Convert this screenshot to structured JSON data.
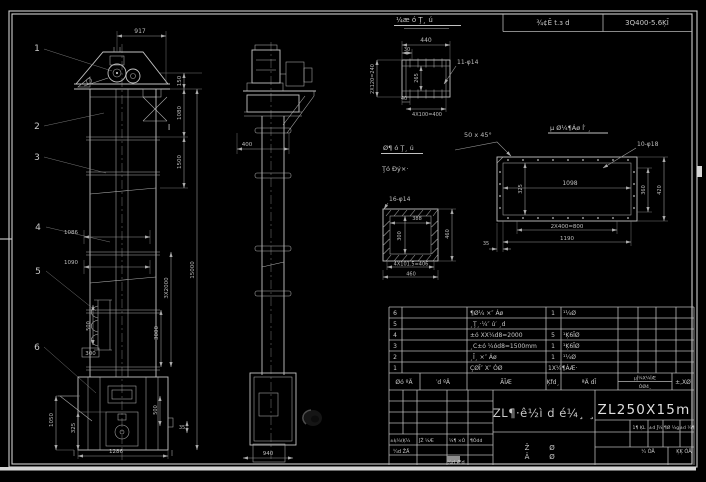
{
  "topbar": {
    "cell1": "¾¢Ē t.з d",
    "cell2": "3Q400-5.6ĶĪ"
  },
  "detail_channel": {
    "title": "¼æ ó Ţ¸ ú",
    "dim_width": "440",
    "dim_offset": "30",
    "dim_left": "2X120=240",
    "dim_inner": "265",
    "holes": "11-φ14",
    "dim_small": "40",
    "dim_bottom": "4X100=400"
  },
  "chamfer_note": "50 x 45°",
  "detail_frame": {
    "title": "µ Ø¼¶Áø ĺ′ ¸",
    "holes": "10-φ18",
    "dim_inner_width": "1098",
    "dim_left": "325",
    "dim_bottom1": "2X400=800",
    "dim_bottom2": "1190",
    "dim_right1": "360",
    "dim_right2": "420",
    "dim_gap": "35"
  },
  "detail_square": {
    "title_line1": "Ø¶ ó Ţ¸ ú",
    "title_line2": "Ţó Ðý×·",
    "holes": "16-φ14",
    "dim_inner_width": "388",
    "dim_inner_height": "300",
    "dim_right": "460",
    "dim_bottom1": "4X101.5=406",
    "dim_bottom2": "460"
  },
  "front_view": {
    "balloons": [
      "1",
      "2",
      "3",
      "4",
      "5",
      "6"
    ],
    "section_mark": "I",
    "box_label": "300",
    "dims": {
      "top_width": "917",
      "head_h": "150",
      "upper_h": "1080",
      "mid_h": "1500",
      "total_h": "15000",
      "sections": "3X2000",
      "w1": "1086",
      "w2": "1090",
      "bucket_pitch": "500",
      "seg": "3000",
      "boot_h": "1050",
      "door_h": "325",
      "boot_w": "1286",
      "spout_h": "500",
      "gap": "35"
    }
  },
  "side_view": {
    "dims": {
      "width": "400",
      "base_width": "940"
    }
  },
  "bom": {
    "headers": {
      "no": "Øó ºÄ",
      "code": "′d ºÄ",
      "name": "ÃĪÆ",
      "qty": "Ķfd¸",
      "material": "ªÄ dĪ",
      "weight_top": "µĴ¼X¼ĪÆ",
      "weight_bottom": "ÓØ4¸",
      "remark": "±,XØ"
    },
    "rows": [
      {
        "no": "6",
        "name": "¶Ø¼ ×″ Áø",
        "qty": "1",
        "material": "¹¼Ø"
      },
      {
        "no": "5",
        "name": "¸Ţ¸·¼″ ú′ ¸d",
        "qty": "",
        "material": ""
      },
      {
        "no": "4",
        "name": "±ó XX¼d8=2000",
        "qty": "5",
        "material": "¹Ķ6ĪØ"
      },
      {
        "no": "3",
        "name": "¸C±ó ¼ód8=1500mm",
        "qty": "1",
        "material": "¹Ķ6ĪØ"
      },
      {
        "no": "2",
        "name": "¸Ī¸ ×″ Áø",
        "qty": "1",
        "material": "¹¼Ø"
      },
      {
        "no": "1",
        "name": "ÇØĪ″ X″ ÓØ",
        "qty": "1X¼¶ÁÆ·",
        "material": ""
      }
    ]
  },
  "title_block": {
    "drawing_title": "ZL¶·ê½ì d é¼¸ ¸",
    "model": "ZL250X15m",
    "stamp": {
      "s1a": "Ž",
      "s1b": "Ä",
      "s2a": "Ø",
      "s2b": "Ø"
    },
    "left_labels": [
      "±ķ¼(Ķ¼",
      "ĴŽ ¼Æ",
      "¼¶ ×Ó",
      "¶Ódd"
    ],
    "sign1": "¼d ŽÄ",
    "sign2": "¼d Æd",
    "right_labels": [
      "1¶ ĶL",
      "±d Ĵ¼",
      "¶Ø ¼g",
      "±d ¼¶"
    ],
    "sheet_info1": "¼ ÓÄ",
    "sheet_info2": "ĶĶ ÓÄ"
  }
}
